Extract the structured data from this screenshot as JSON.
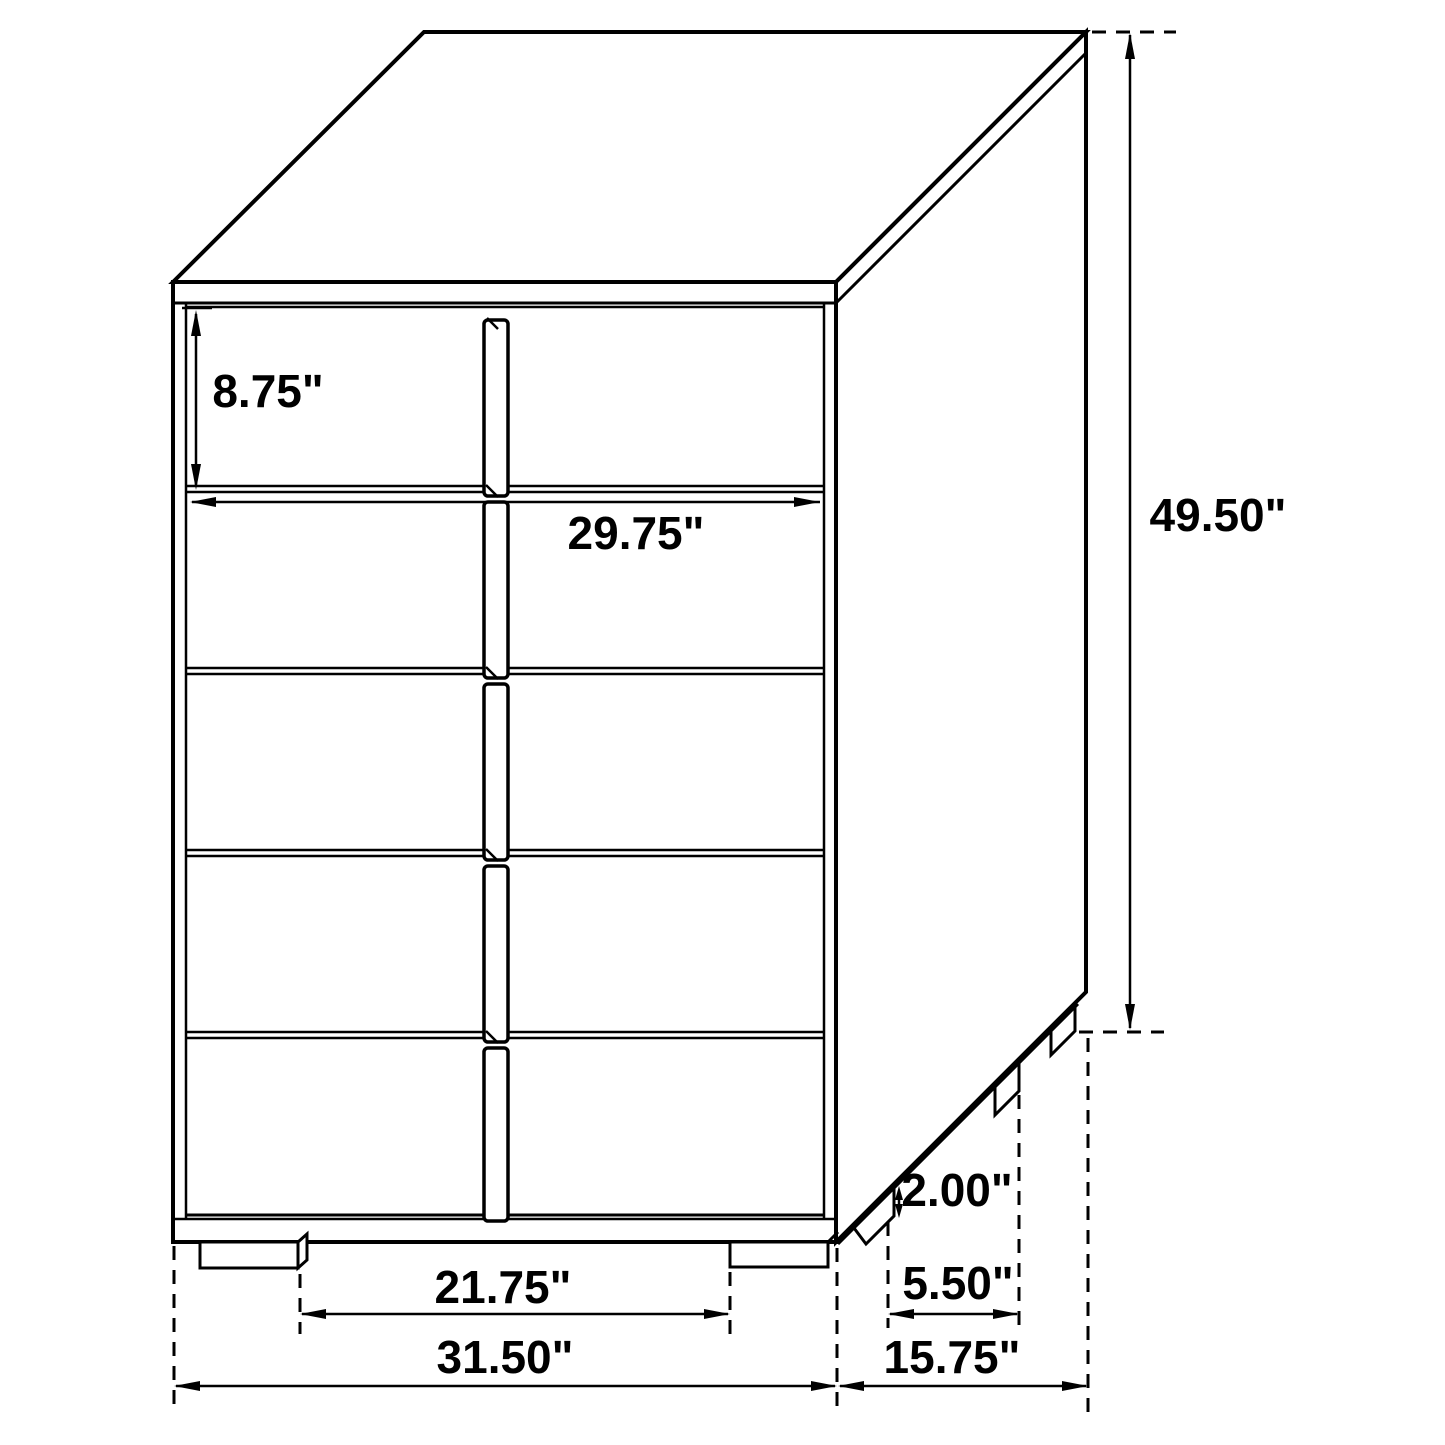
{
  "diagram": {
    "title": "5-drawer chest technical dimension diagram",
    "unit": "inches",
    "drawer_count": 5,
    "colors": {
      "line": "#000000",
      "background": "#ffffff"
    },
    "dimensions": {
      "drawer_height": {
        "name": "drawer height",
        "value": 8.75,
        "label": "8.75\""
      },
      "interior_width": {
        "name": "drawer front width",
        "value": 29.75,
        "label": "29.75\""
      },
      "overall_height": {
        "name": "overall height",
        "value": 49.5,
        "label": "49.50\""
      },
      "foot_height": {
        "name": "foot height",
        "value": 2.0,
        "label": "2.00\""
      },
      "foot_spacing_side": {
        "name": "side foot spacing",
        "value": 5.5,
        "label": "5.50\""
      },
      "foot_spacing_front": {
        "name": "front foot spacing",
        "value": 21.75,
        "label": "21.75\""
      },
      "overall_width": {
        "name": "overall width",
        "value": 31.5,
        "label": "31.50\""
      },
      "overall_depth": {
        "name": "overall depth",
        "value": 15.75,
        "label": "15.75\""
      }
    }
  }
}
